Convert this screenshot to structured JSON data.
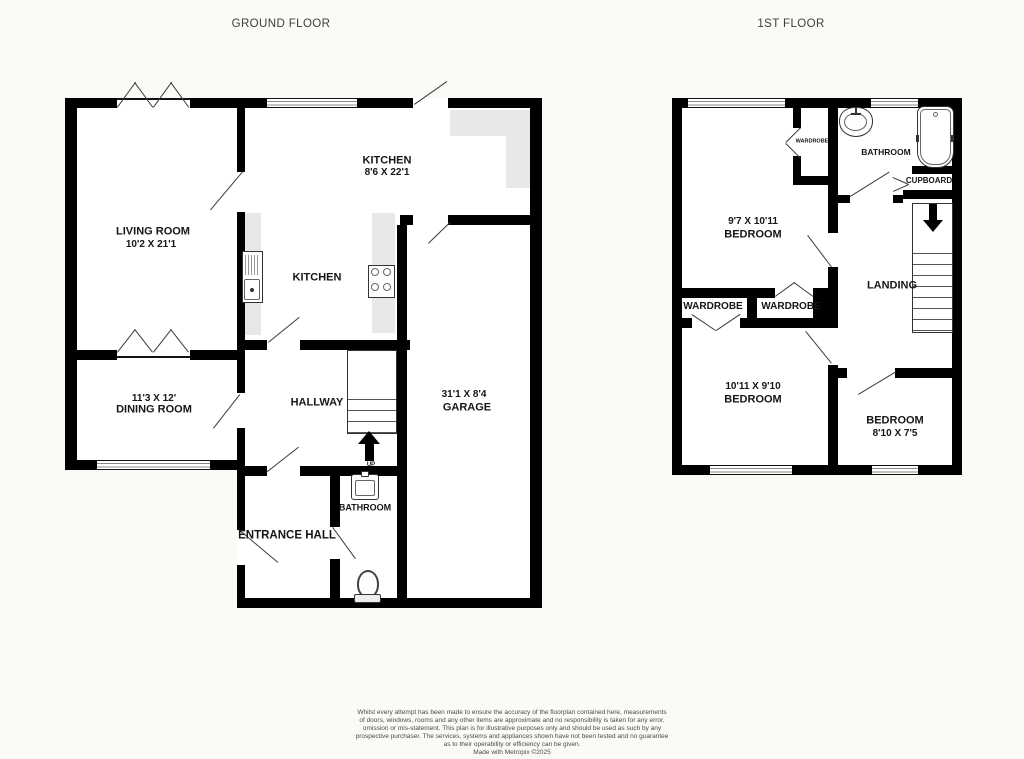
{
  "titles": {
    "ground": "GROUND FLOOR",
    "first": "1ST FLOOR"
  },
  "ground_floor": {
    "living_room": {
      "name": "LIVING ROOM",
      "dims": "10'2 X 21'1"
    },
    "kitchen": {
      "name": "KITCHEN",
      "dims": "8'6 X 22'1"
    },
    "kitchen2": {
      "name": "KITCHEN"
    },
    "dining_room": {
      "name": "DINING ROOM",
      "dims": "11'3 X 12'"
    },
    "hallway": {
      "name": "HALLWAY"
    },
    "garage": {
      "name": "GARAGE",
      "dims": "31'1 X 8'4"
    },
    "bathroom": {
      "name": "BATHROOM"
    },
    "entrance_hall": {
      "name": "ENTRANCE HALL"
    },
    "stairs_label": "UP"
  },
  "first_floor": {
    "bedroom1": {
      "name": "BEDROOM",
      "dims": "9'7 X 10'11"
    },
    "bathroom": {
      "name": "BATHROOM"
    },
    "cupboard": {
      "name": "CUPBOARD"
    },
    "landing": {
      "name": "LANDING"
    },
    "wardrobe_small": {
      "name": "WARDROBE"
    },
    "wardrobe_left": {
      "name": "WARDROBE"
    },
    "wardrobe_right": {
      "name": "WARDROBE"
    },
    "bedroom2": {
      "name": "BEDROOM",
      "dims": "10'11 X 9'10"
    },
    "bedroom3": {
      "name": "BEDROOM",
      "dims": "8'10 X 7'5"
    }
  },
  "icons": {
    "kitchen_sink": "kitchen-sink-icon",
    "hob": "hob-icon",
    "toilet": "toilet-icon",
    "basin": "basin-icon",
    "bath": "bath-icon",
    "stairs_up": "stairs-up-arrow-icon",
    "stairs_down": "stairs-down-arrow-icon"
  },
  "colors": {
    "wall": "#000000",
    "counter": "#e8e8e8",
    "text": "#161616"
  },
  "footer": {
    "disclaimer_lines": [
      "Whilst every attempt has been made to ensure the accuracy of the floorplan contained here, measurements",
      "of doors, windows, rooms and any other items are approximate and no responsibility is taken for any error,",
      "omission or mis-statement. This plan is for illustrative purposes only and should be used as such by any",
      "prospective purchaser. The services, systems and appliances shown have not been tested and no guarantee",
      "as to their operability or efficiency can be given."
    ],
    "credit": "Made with Metropix ©2025"
  }
}
